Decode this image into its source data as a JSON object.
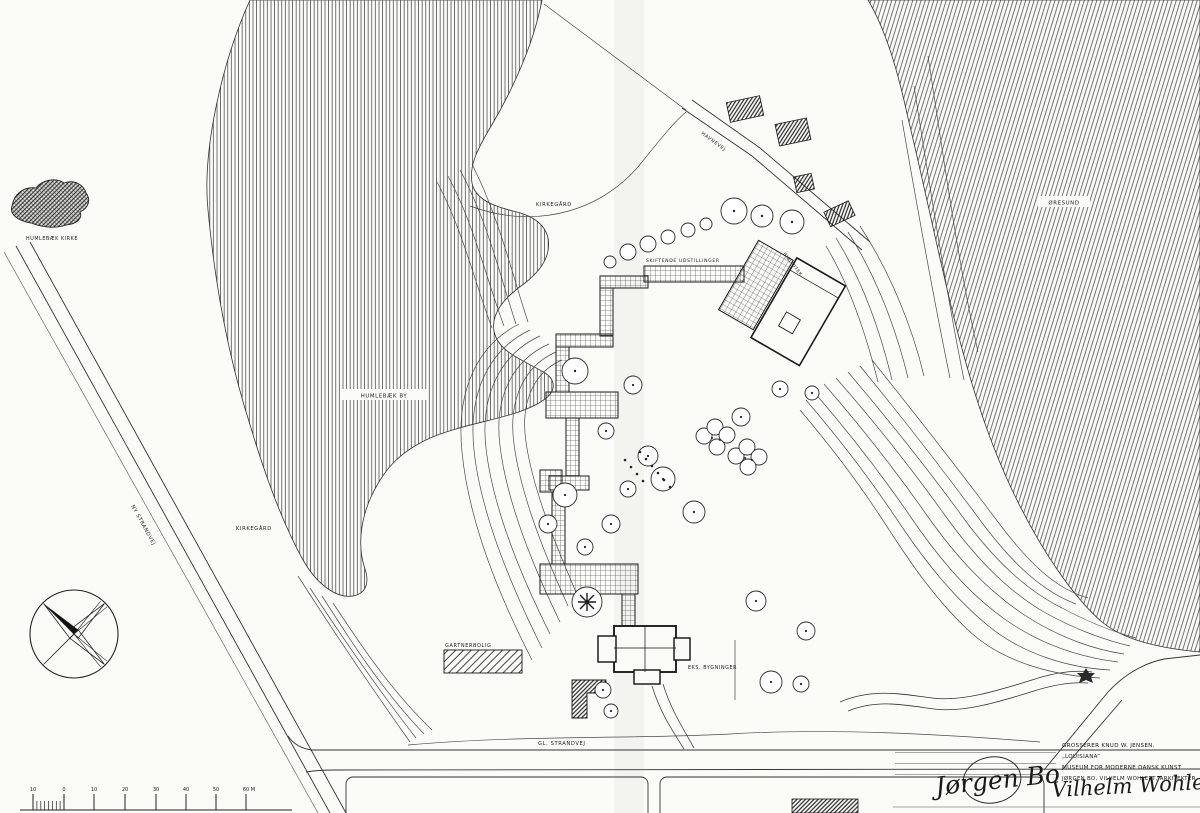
{
  "drawing_title": "Louisiana museum site plan",
  "labels": {
    "humlebaek_kirke": "HUMLEBÆK KIRKE",
    "kirkegaard_top": "KIRKEGÅRD",
    "kirkegaard_west": "KIRKEGÅRD",
    "humlebaek_by": "HUMLEBÆK BY",
    "oeresund": "ØRESUND",
    "ny_strandvej": "NY STRANDVEJ",
    "havnevej": "HAVNEVEJ",
    "gl_strandvej": "GL. STRANDVEJ",
    "skiftende_udstillinger": "SKIFTENDE UDSTILLINGER",
    "bibliotek": "BIBLIOTEK",
    "gartnerbolig": "GARTNERBOLIG",
    "eks_bygninger": "EKS. BYGNINGER"
  },
  "title_block": {
    "owner": "GROSSERER KNUD W. JENSEN.",
    "project_name": "„LOUISIANA”",
    "subtitle": "MUSEUM FOR MODERNE DANSK KUNST",
    "architects": "JØRGEN BO, VILHELM WOHLERT, ARKITEKTER, M.A.A.",
    "signature_bo": "Jørgen Bo",
    "signature_wohlert": "Vilhelm Wohlert."
  },
  "scale_bar": {
    "ticks": [
      "10",
      "0",
      "10",
      "20",
      "30",
      "40",
      "50",
      "60 M"
    ]
  },
  "icons": {
    "compass_rose": "four-point-star north indicator",
    "flower_tree": "asterisk tree symbol",
    "marsh_symbol": "small filled marsh blob"
  },
  "colors": {
    "ink": "#1a1a1a",
    "paper": "#fbfbf8"
  }
}
